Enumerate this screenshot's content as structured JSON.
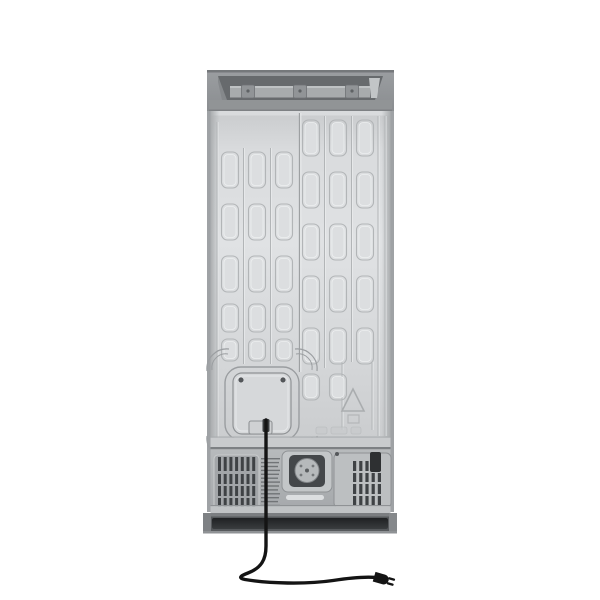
{
  "meta": {
    "description": "Rear view product photo of a stainless refrigerator showing embossed back panel, compressor compartment and power cord",
    "canvas": {
      "width": 600,
      "height": 600
    },
    "background": "#ffffff"
  },
  "palette": {
    "cap_face": "#90939a",
    "cap_edge": "#75787b",
    "cap_recess": "#676a6d",
    "cap_rail": "#a8abad",
    "cap_clip": "#919497",
    "panel_light": "#e0e2e4",
    "panel_mid": "#d4d6d8",
    "panel_dark": "#c6c8ca",
    "emboss_line": "#b2b5b7",
    "emboss_light": "#edeff0",
    "seam_line": "#9da0a2",
    "bay_face": "#b4b7b9",
    "bay_shadow": "#7d8083",
    "slat_dark": "#3f4245",
    "fitting_dark": "#44474a",
    "fitting_knob": "#b6b9bb",
    "label_dark": "#2e3032",
    "kick_face": "#56595c",
    "kick_recess": "#25272a",
    "kick_lip": "#c0c3c5",
    "screw": "#55585b",
    "cord": "#141414",
    "mark_line": "#9b9ea1"
  },
  "parts": [
    {
      "name": "top-mounting-rail",
      "description": "recessed top cap with hinge rail and three clips"
    },
    {
      "name": "embossed-back-panel",
      "description": "sheet metal back with stamped reinforcement slots"
    },
    {
      "name": "access-panel",
      "description": "square service access cover with two screws and corner marks"
    },
    {
      "name": "warning-triangle-emboss",
      "description": "stamped triangle symbol"
    },
    {
      "name": "embossed-marking",
      "description": "faint illegible stamped marking"
    },
    {
      "name": "compressor-compartment",
      "description": "lower machine bay with ventilation grilles"
    },
    {
      "name": "water-inlet-fitting",
      "description": "central valve fitting with round knob"
    },
    {
      "name": "serial-label",
      "description": "small dark label on right panel"
    },
    {
      "name": "kick-plate",
      "description": "dark recessed base bar"
    },
    {
      "name": "power-cord",
      "description": "black cord ending in two-prong plug"
    }
  ],
  "pattern": {
    "slot": {
      "w": 17,
      "rx": 6,
      "inset": 2.5
    },
    "columns": [
      {
        "cx": 230,
        "rows": [
          [
            152,
            36
          ],
          [
            204,
            36
          ],
          [
            256,
            36
          ],
          [
            304,
            28
          ],
          [
            339,
            22
          ]
        ]
      },
      {
        "cx": 257,
        "rows": [
          [
            152,
            36
          ],
          [
            204,
            36
          ],
          [
            256,
            36
          ],
          [
            304,
            28
          ],
          [
            339,
            22
          ]
        ]
      },
      {
        "cx": 284,
        "rows": [
          [
            152,
            36
          ],
          [
            204,
            36
          ],
          [
            256,
            36
          ],
          [
            304,
            28
          ],
          [
            339,
            22
          ]
        ]
      },
      {
        "cx": 311,
        "rows": [
          [
            120,
            36
          ],
          [
            172,
            36
          ],
          [
            224,
            36
          ],
          [
            276,
            36
          ],
          [
            328,
            36
          ],
          [
            374,
            26
          ]
        ]
      },
      {
        "cx": 338,
        "rows": [
          [
            120,
            36
          ],
          [
            172,
            36
          ],
          [
            224,
            36
          ],
          [
            276,
            36
          ],
          [
            328,
            36
          ],
          [
            374,
            26
          ]
        ]
      },
      {
        "cx": 365,
        "rows": [
          [
            120,
            36
          ],
          [
            172,
            36
          ],
          [
            224,
            36
          ],
          [
            276,
            36
          ],
          [
            328,
            36
          ]
        ]
      }
    ],
    "ridges": [
      {
        "x": 217,
        "y1": 122,
        "y2": 438
      },
      {
        "x": 243.5,
        "y1": 148,
        "y2": 364
      },
      {
        "x": 270.5,
        "y1": 148,
        "y2": 364
      },
      {
        "x": 324.5,
        "y1": 116,
        "y2": 368
      },
      {
        "x": 351.5,
        "y1": 116,
        "y2": 362
      },
      {
        "x": 378,
        "y1": 116,
        "y2": 436
      },
      {
        "x": 385,
        "y1": 116,
        "y2": 436
      },
      {
        "x": 342,
        "y1": 362,
        "y2": 430
      },
      {
        "x": 372,
        "y1": 362,
        "y2": 430
      }
    ],
    "seam": {
      "x": 299.5,
      "y1": 113,
      "y2": 372
    }
  },
  "access_panel": {
    "outer": {
      "x": 225,
      "y": 367,
      "w": 74,
      "h": 73,
      "rx": 16
    },
    "inner": {
      "x": 233,
      "y": 373,
      "w": 58,
      "h": 61,
      "rx": 9
    },
    "tab": {
      "x": 249,
      "y": 421,
      "w": 23,
      "h": 13
    },
    "cord_grommet": {
      "x": 262.5,
      "y": 419,
      "w": 7,
      "h": 13
    },
    "screws": [
      [
        241,
        380
      ],
      [
        283,
        380
      ]
    ],
    "corners": [
      [
        225,
        367,
        0
      ],
      [
        299,
        367,
        90
      ],
      [
        299,
        440,
        180
      ],
      [
        225,
        440,
        270
      ]
    ]
  },
  "machine_bay": {
    "left_vent": {
      "x": 214,
      "y": 455,
      "w": 45,
      "h": 54,
      "inner_x": 218,
      "rows": [
        [
          457,
          14
        ],
        [
          474,
          10
        ],
        [
          486,
          10
        ],
        [
          498,
          11
        ]
      ],
      "slats": 7,
      "slat_w": 3,
      "gap": 2.7
    },
    "micro_slats": {
      "x": 261,
      "w": 19,
      "y": 458,
      "count": 13,
      "step": 3.9,
      "h": 1.4
    },
    "right_vent": {
      "inner_x": 353,
      "rows": [
        [
          461,
          10
        ],
        [
          473,
          9
        ],
        [
          484,
          10
        ],
        [
          496,
          10
        ]
      ],
      "slats": 5,
      "slat_w": 3.2,
      "gap": 3
    },
    "screws": [
      [
        337,
        454
      ]
    ]
  },
  "cord": {
    "path": "M266,420 L266,546 C266,560 261,568 248,573 C240,576 238,578 245,579.5 C268,583.5 306,584.5 333,580.5 C352,577.5 366,576.5 377,577.5",
    "plug_at": [
      377,
      577.5
    ],
    "plug_angle": 16
  }
}
